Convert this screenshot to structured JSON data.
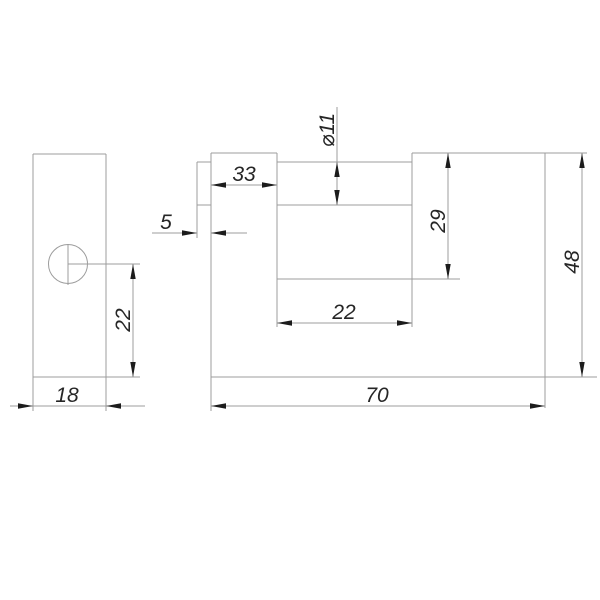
{
  "drawing": {
    "kind": "technical-drawing",
    "subject": "shutter padlock, two orthographic views with dimensions",
    "colors": {
      "line": "#9c9c9c",
      "arrow": "#1c1c1c",
      "text": "#262626",
      "background": "#ffffff"
    },
    "dimensions": {
      "side_width": "18",
      "side_keyhole_offset": "22",
      "pin_step": "5",
      "boss_width": "33",
      "shackle_diameter": "⌀11",
      "slot_height": "29",
      "slot_width": "22",
      "body_width": "70",
      "body_height": "48"
    }
  }
}
